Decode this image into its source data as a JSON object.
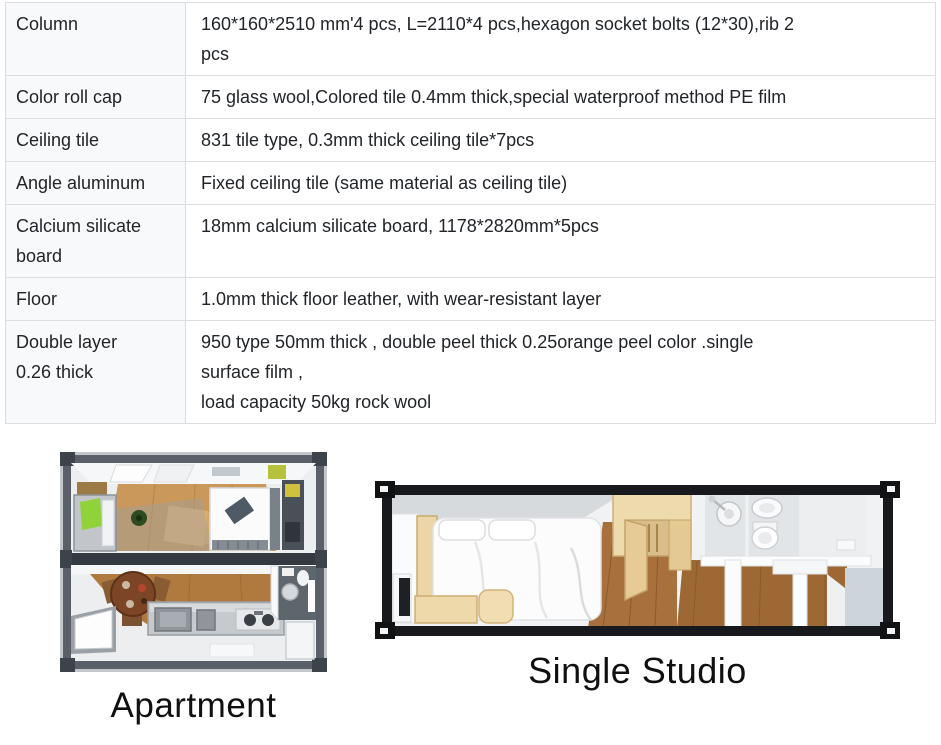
{
  "spec_table": {
    "rows": [
      {
        "label": "Column",
        "spec": "160*160*2510 mm'4 pcs, L=2110*4 pcs,hexagon socket bolts (12*30),rib 2\npcs"
      },
      {
        "label": "Color roll cap",
        "spec": "75 glass wool,Colored tile 0.4mm thick,special waterproof method PE film"
      },
      {
        "label": "Ceiling tile",
        "spec": "831 tile type, 0.3mm thick ceiling tile*7pcs"
      },
      {
        "label": "Angle aluminum",
        "spec": "Fixed ceiling tile (same material as ceiling tile)"
      },
      {
        "label": "Calcium silicate\nboard",
        "spec": "18mm calcium silicate board, 1178*2820mm*5pcs"
      },
      {
        "label": "Floor",
        "spec": "1.0mm thick floor leather, with wear-resistant layer"
      },
      {
        "label": "Double layer\n0.26 thick",
        "spec": "950 type 50mm thick , double peel thick 0.25orange peel color .single\nsurface film ,\nload capacity 50kg rock wool"
      }
    ],
    "colors": {
      "label_column_bg": "#f8f9fa",
      "border": "#dadde1",
      "text": "#212529"
    }
  },
  "floorplans": {
    "apartment": {
      "caption": "Apartment"
    },
    "studio": {
      "caption": "Single Studio"
    }
  }
}
